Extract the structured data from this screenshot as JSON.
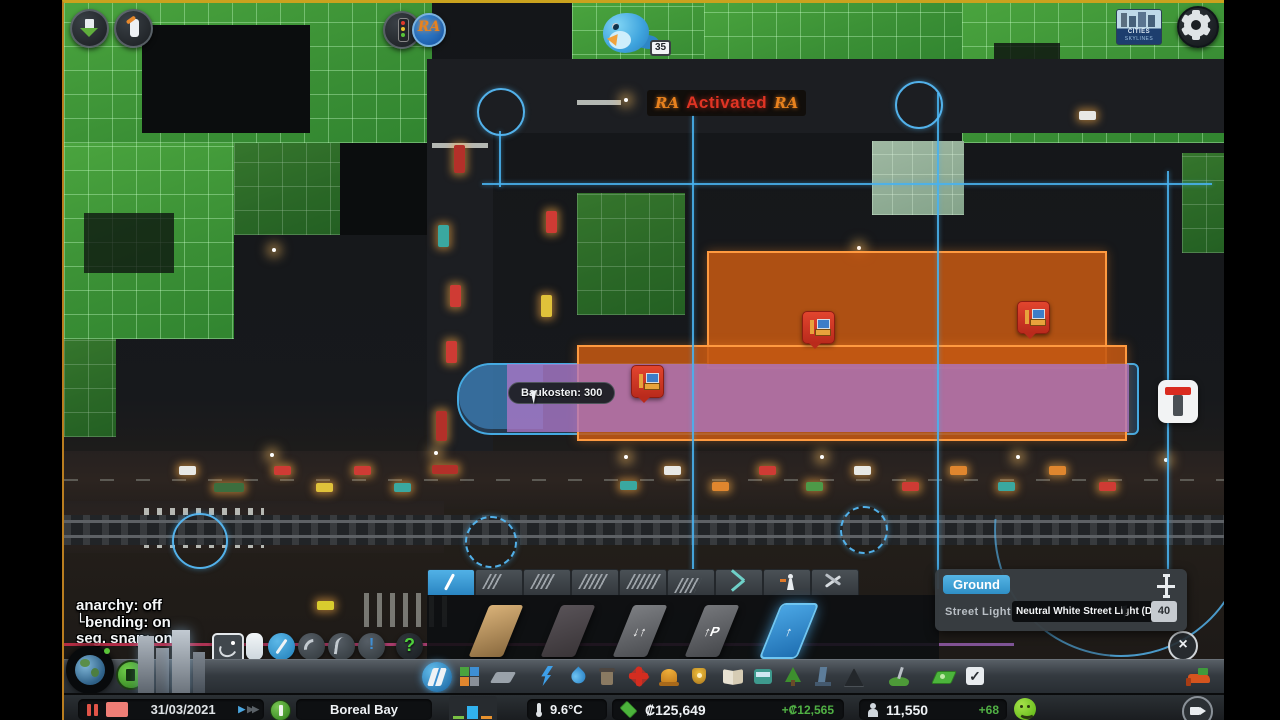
{
  "game": "Cities: Skylines",
  "chirper": {
    "badge": "35"
  },
  "activated_sign": {
    "left_logo": "RA",
    "text": "Activated",
    "right_logo": "RA"
  },
  "ra_button_label": "RA",
  "tooltip": {
    "text": "Baukosten: 300"
  },
  "brand_logo": {
    "line1": "CITIES",
    "line2": "SKYLINES"
  },
  "anarchy_panel": {
    "line1": "anarchy: off",
    "line2_prefix": "└",
    "line2": "bending: on",
    "line3": "seg. snap: on"
  },
  "fine_road_tool": {
    "warn_glyph": "!",
    "help_glyph": "?"
  },
  "roads_panel": {
    "thumbs": [
      {
        "name": "gravel-road",
        "glyph": ""
      },
      {
        "name": "basic-road",
        "glyph": ""
      },
      {
        "name": "two-way-road",
        "glyph": "↓↑"
      },
      {
        "name": "oneway-road-parking",
        "glyph": "↑P"
      },
      {
        "name": "oneway-road",
        "glyph": "↑"
      }
    ],
    "close_glyph": "×"
  },
  "ground_panel": {
    "tab_label": "Ground",
    "row_label": "Street Light",
    "dropdown_value": "Neutral White Street Light (Def",
    "value": "40"
  },
  "policies_check_glyph": "✓",
  "status_bar": {
    "date": "31/03/2021",
    "play_glyph": "▶",
    "ff_glyph": "▶▶",
    "city_name": "Boreal Bay",
    "temperature": "9.6°C",
    "money": "₡125,649",
    "money_delta": "+₡12,565",
    "population": "11,550",
    "population_delta": "+68"
  }
}
